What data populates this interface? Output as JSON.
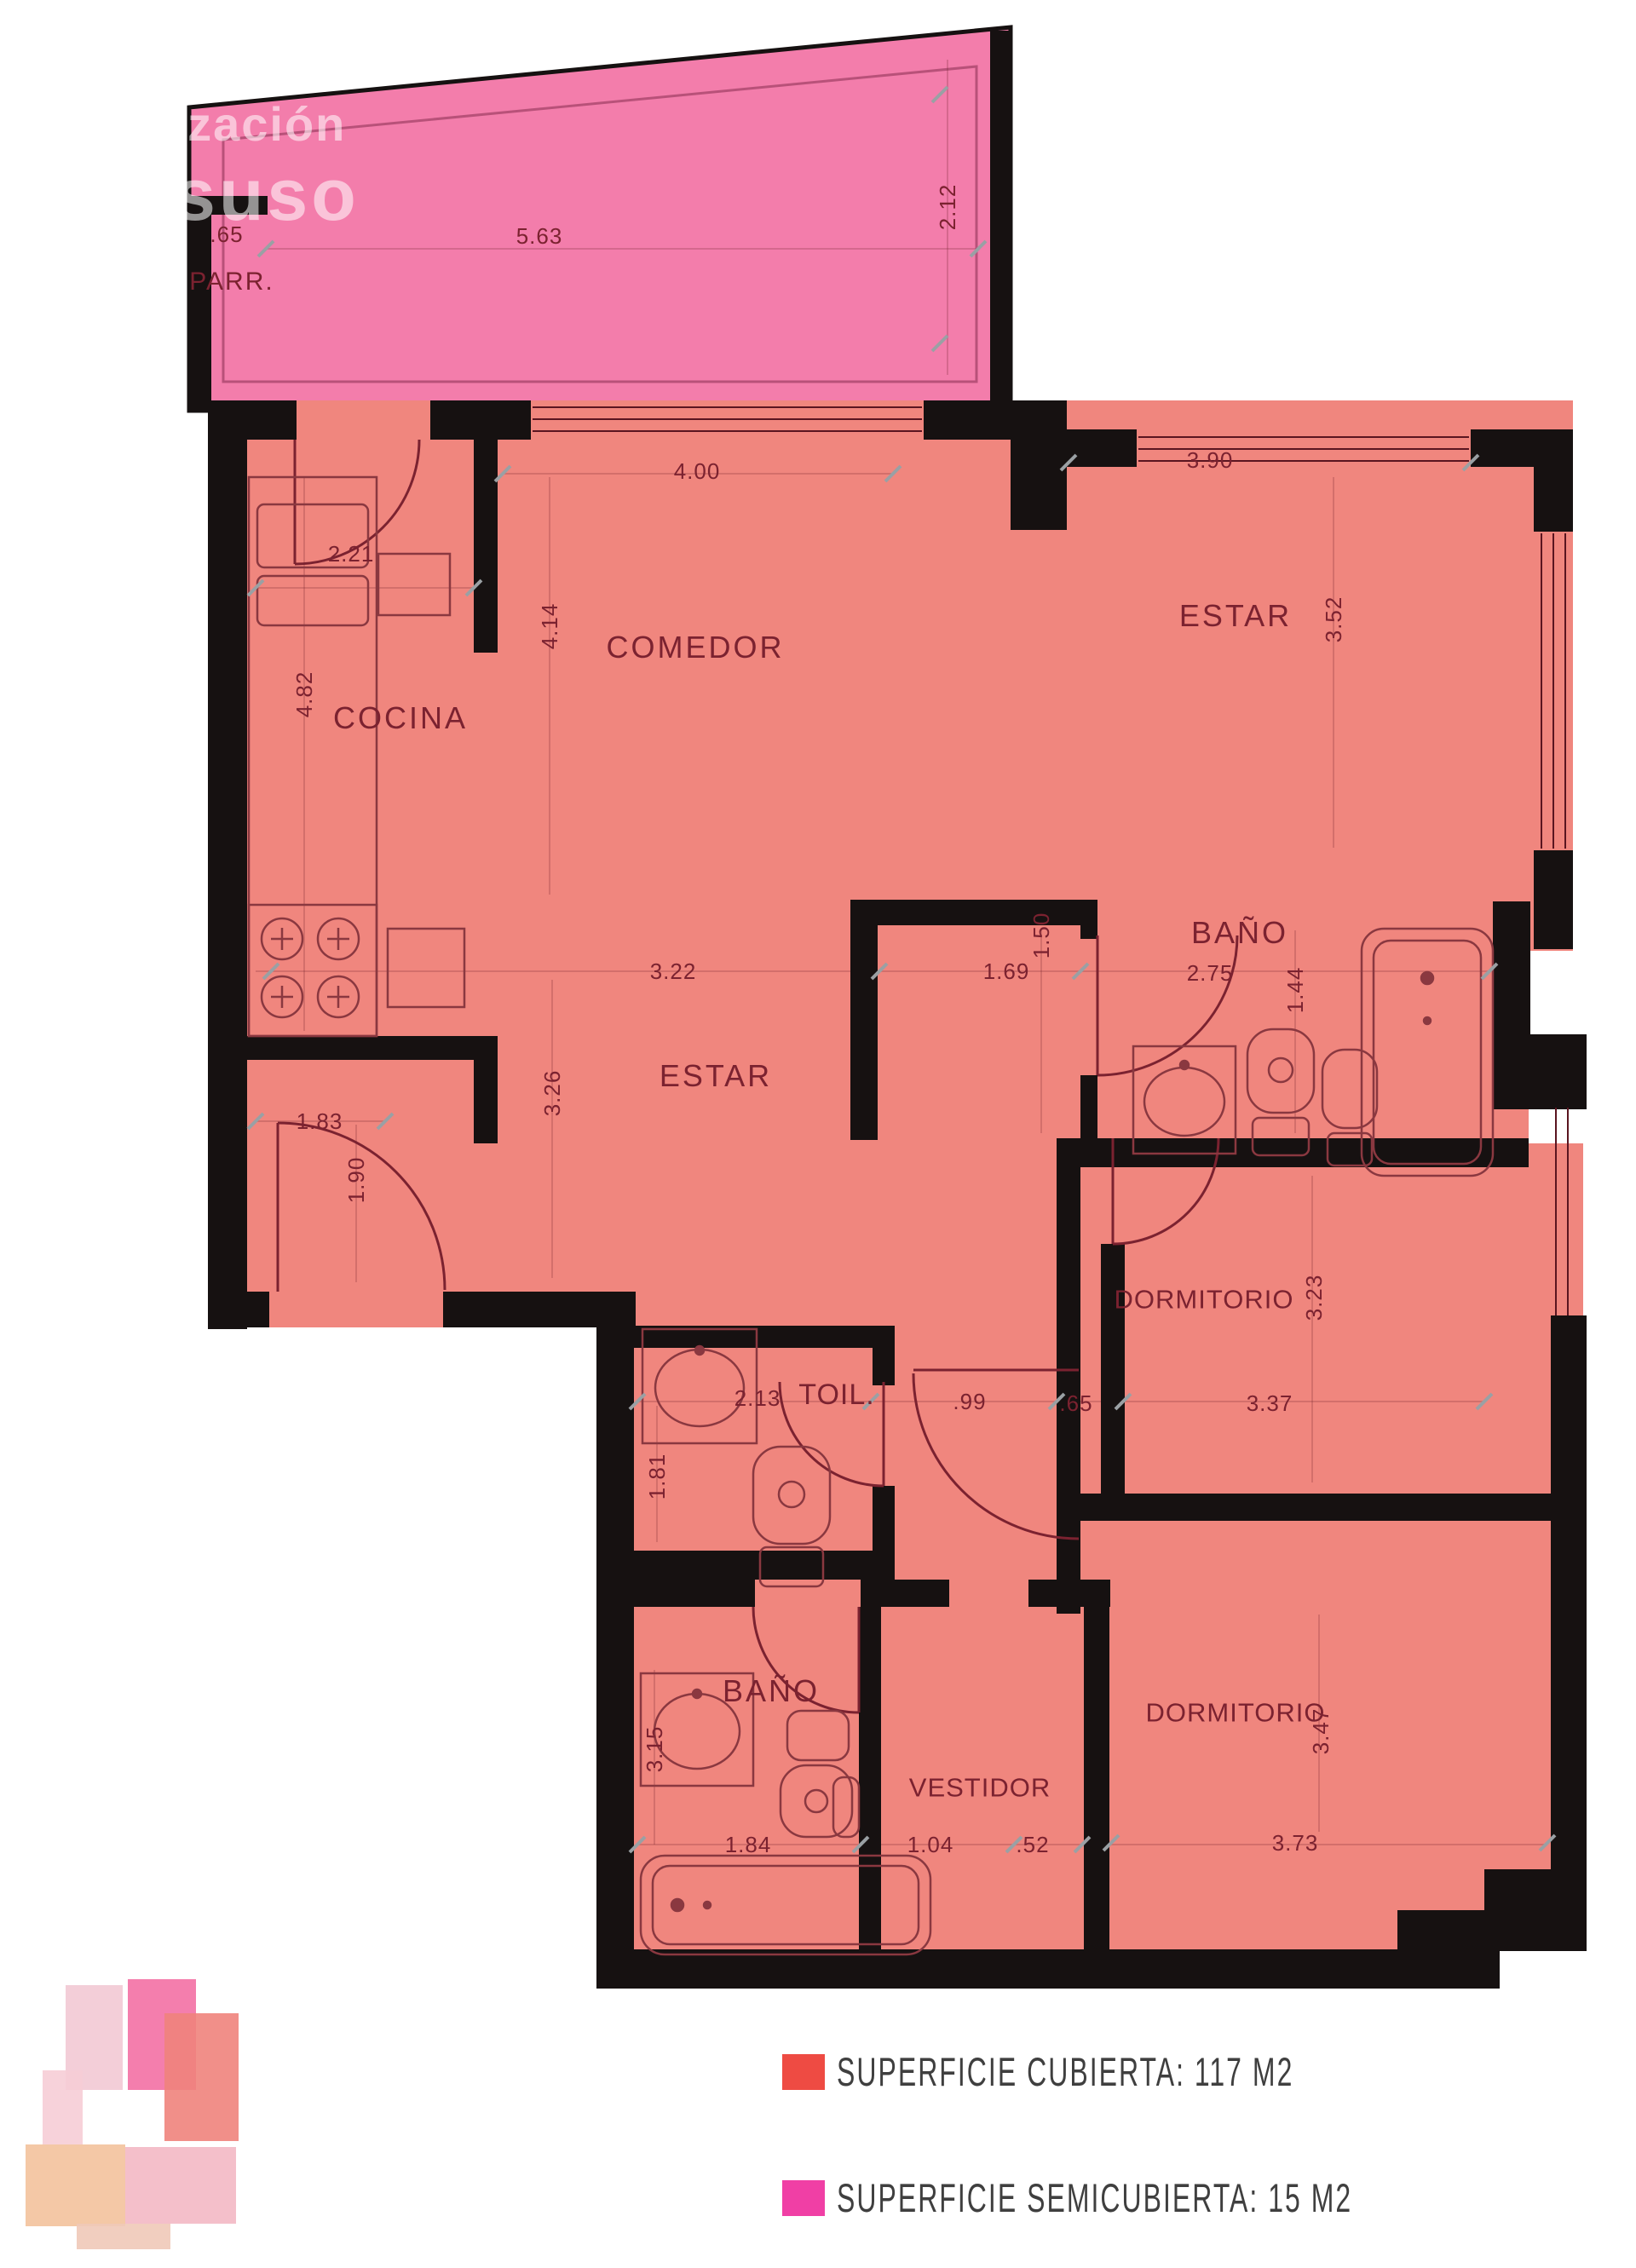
{
  "watermark": {
    "line1": "lización",
    "line2": "suso"
  },
  "terrace": {
    "name": "PARR.",
    "dim_left": ".65",
    "dim_top": "5.63",
    "dim_side": "2.12"
  },
  "rooms": {
    "cocina": {
      "name": "COCINA",
      "w": "2.21",
      "h": "4.82"
    },
    "comedor": {
      "name": "COMEDOR",
      "w": "4.00",
      "h": "4.14"
    },
    "estar_norte": {
      "name": "ESTAR",
      "w": "3.90",
      "h": "3.52"
    },
    "estar": {
      "name": "ESTAR",
      "w": "3.22",
      "h": "3.26"
    },
    "bano_suite": {
      "name": "BAÑO",
      "w": "2.75",
      "h": "1.44",
      "acceso_w": "1.69",
      "acceso_h": "1.50"
    },
    "entrada": {
      "w": "1.83",
      "h": "1.90"
    },
    "toilette": {
      "name": "TOIL.",
      "w": "2.13",
      "h": "1.81"
    },
    "pasillo": {
      "w": ".99",
      "w2": ".65"
    },
    "dormitorio1": {
      "name": "DORMITORIO",
      "w": "3.37",
      "h": "3.23"
    },
    "bano2": {
      "name": "BAÑO",
      "w": "1.84",
      "h": "3.15"
    },
    "vestidor": {
      "name": "VESTIDOR",
      "w": "1.04",
      "w2": ".52"
    },
    "dormitorio2": {
      "name": "DORMITORIO",
      "w": "3.73",
      "h": "3.47"
    }
  },
  "legend": {
    "items": [
      {
        "label": "SUPERFICIE CUBIERTA: 117 M2",
        "color": "#ee4b43"
      },
      {
        "label": "SUPERFICIE SEMICUBIERTA: 15 M2",
        "color": "#f03fa5"
      }
    ]
  },
  "colors": {
    "covered_fill": "#f0867e",
    "semicovered_fill": "#f37dab",
    "wall": "#161111",
    "dim_text": "#7b2230"
  }
}
